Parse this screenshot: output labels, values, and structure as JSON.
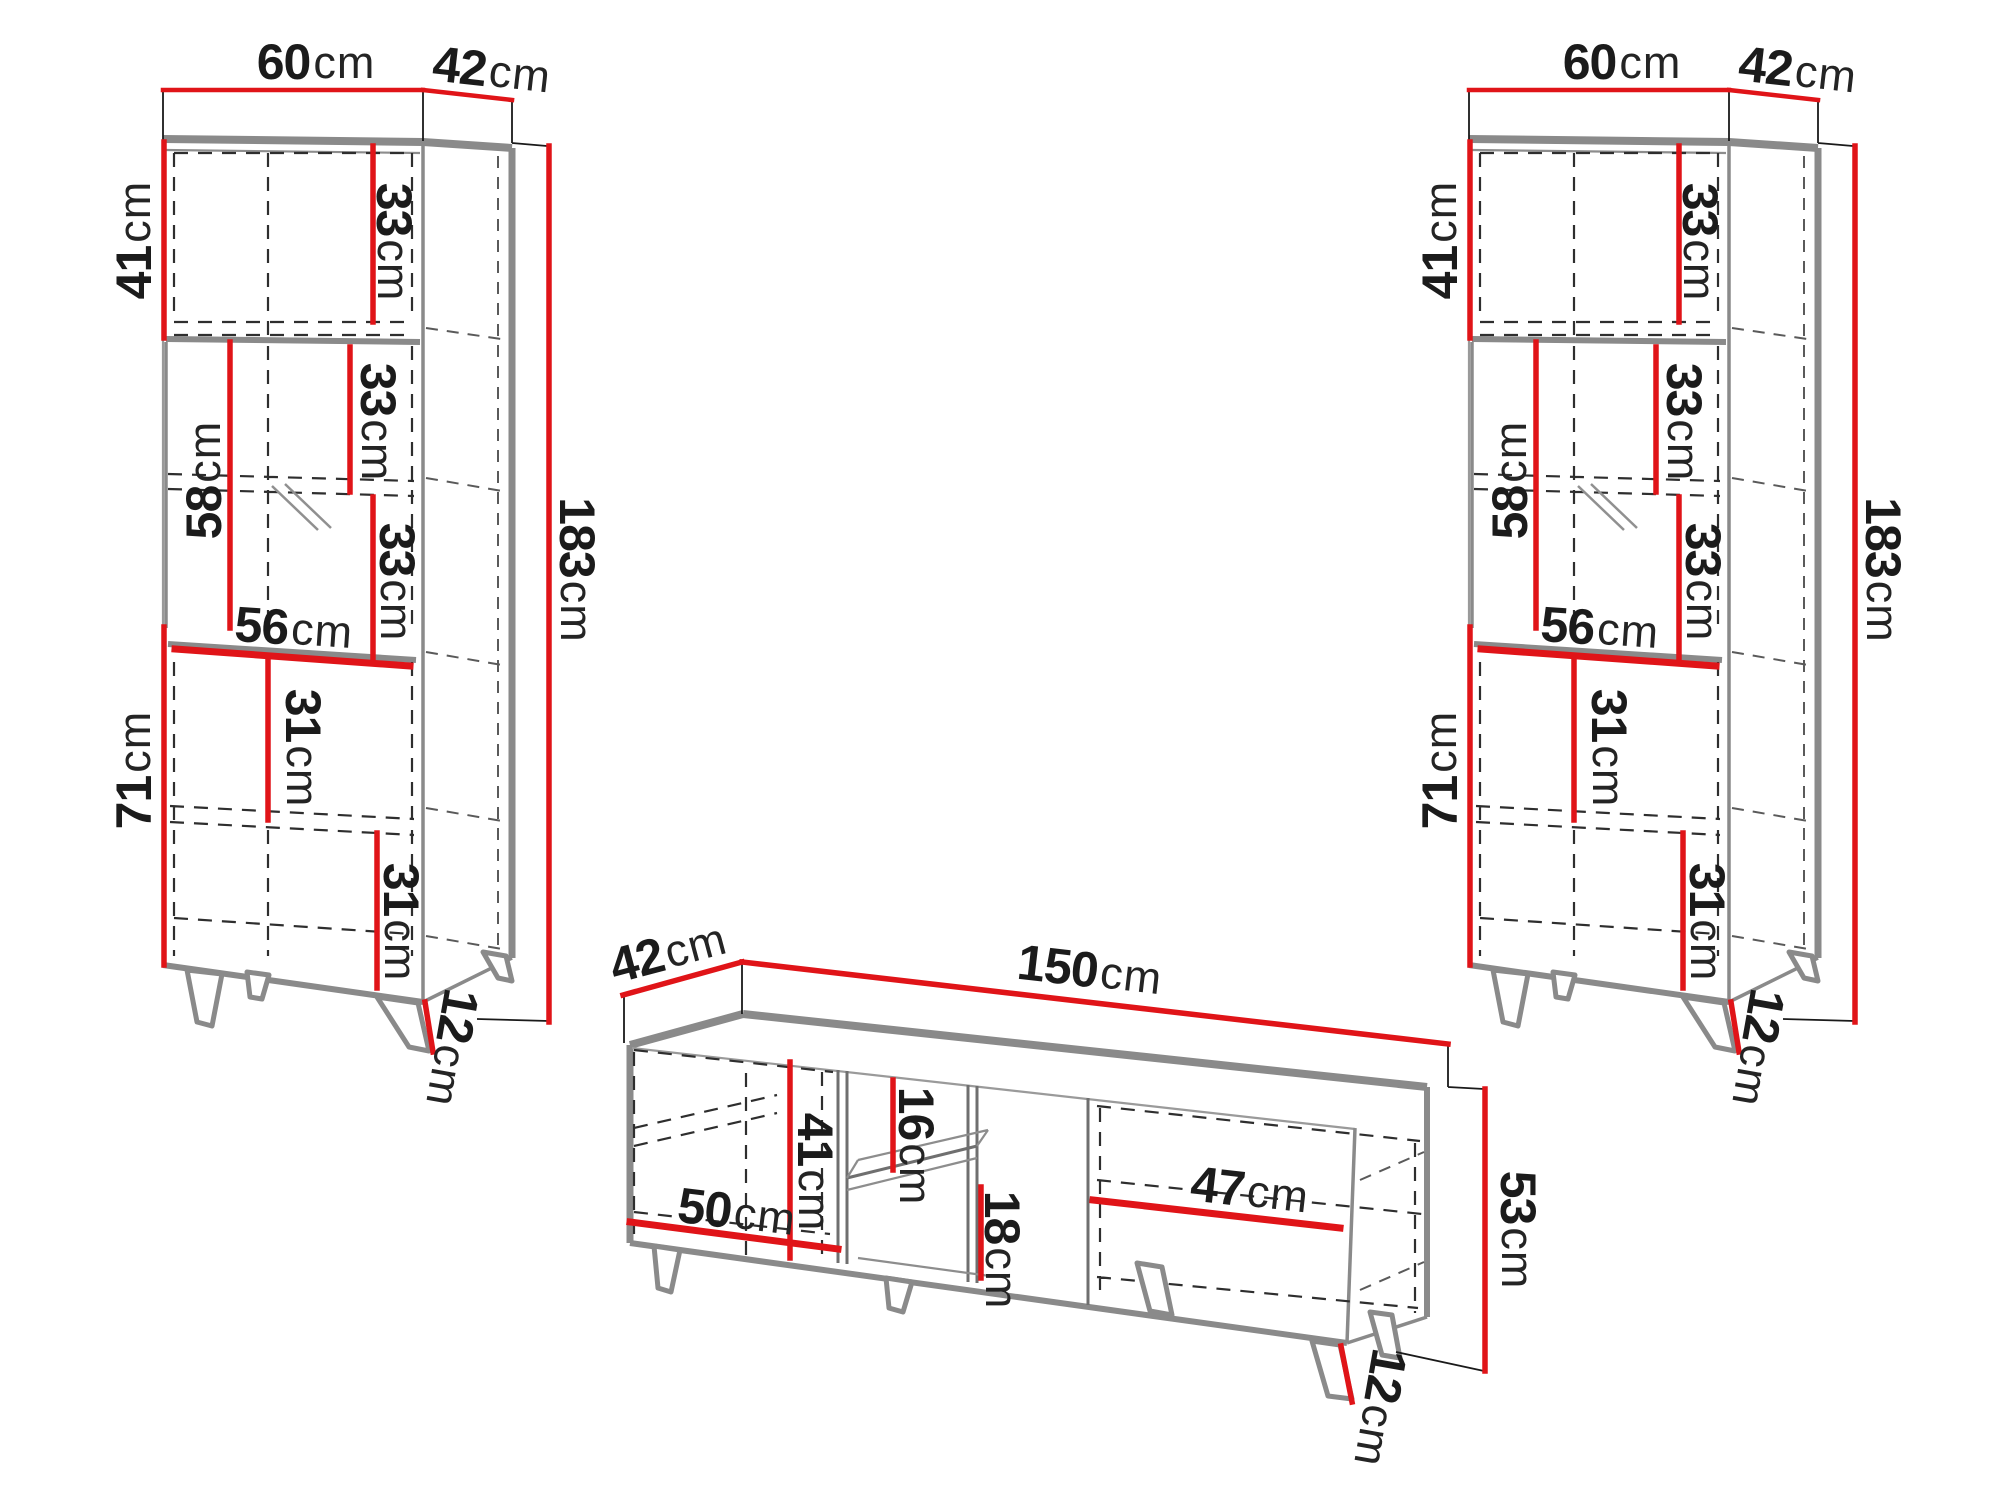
{
  "left_cabinet": {
    "top_width": {
      "v": "60",
      "u": "cm"
    },
    "top_depth": {
      "v": "42",
      "u": "cm"
    },
    "upper_height": {
      "v": "41",
      "u": "cm"
    },
    "upper_shelf": {
      "v": "33",
      "u": "cm"
    },
    "middle_height": {
      "v": "58",
      "u": "cm"
    },
    "middle_shelf_upper": {
      "v": "33",
      "u": "cm"
    },
    "middle_shelf_lower": {
      "v": "33",
      "u": "cm"
    },
    "inner_width": {
      "v": "56",
      "u": "cm"
    },
    "lower_height": {
      "v": "71",
      "u": "cm"
    },
    "lower_shelf_upper": {
      "v": "31",
      "u": "cm"
    },
    "lower_shelf_lower": {
      "v": "31",
      "u": "cm"
    },
    "leg_height": {
      "v": "12",
      "u": "cm"
    },
    "total_height": {
      "v": "183",
      "u": "cm"
    }
  },
  "right_cabinet": {
    "top_width": {
      "v": "60",
      "u": "cm"
    },
    "top_depth": {
      "v": "42",
      "u": "cm"
    },
    "upper_height": {
      "v": "41",
      "u": "cm"
    },
    "upper_shelf": {
      "v": "33",
      "u": "cm"
    },
    "middle_height": {
      "v": "58",
      "u": "cm"
    },
    "middle_shelf_upper": {
      "v": "33",
      "u": "cm"
    },
    "middle_shelf_lower": {
      "v": "33",
      "u": "cm"
    },
    "inner_width": {
      "v": "56",
      "u": "cm"
    },
    "lower_height": {
      "v": "71",
      "u": "cm"
    },
    "lower_shelf_upper": {
      "v": "31",
      "u": "cm"
    },
    "lower_shelf_lower": {
      "v": "31",
      "u": "cm"
    },
    "leg_height": {
      "v": "12",
      "u": "cm"
    },
    "total_height": {
      "v": "183",
      "u": "cm"
    }
  },
  "tv_stand": {
    "depth": {
      "v": "42",
      "u": "cm"
    },
    "width": {
      "v": "150",
      "u": "cm"
    },
    "door_height": {
      "v": "41",
      "u": "cm"
    },
    "niche_upper": {
      "v": "16",
      "u": "cm"
    },
    "niche_lower": {
      "v": "18",
      "u": "cm"
    },
    "door_width": {
      "v": "50",
      "u": "cm"
    },
    "right_width": {
      "v": "47",
      "u": "cm"
    },
    "body_height": {
      "v": "53",
      "u": "cm"
    },
    "leg_height": {
      "v": "12",
      "u": "cm"
    }
  },
  "colors": {
    "dimension_red": "#e01418",
    "outline_gray": "#8a8a8a",
    "construction_black": "#1a1a1a",
    "background": "#ffffff"
  }
}
